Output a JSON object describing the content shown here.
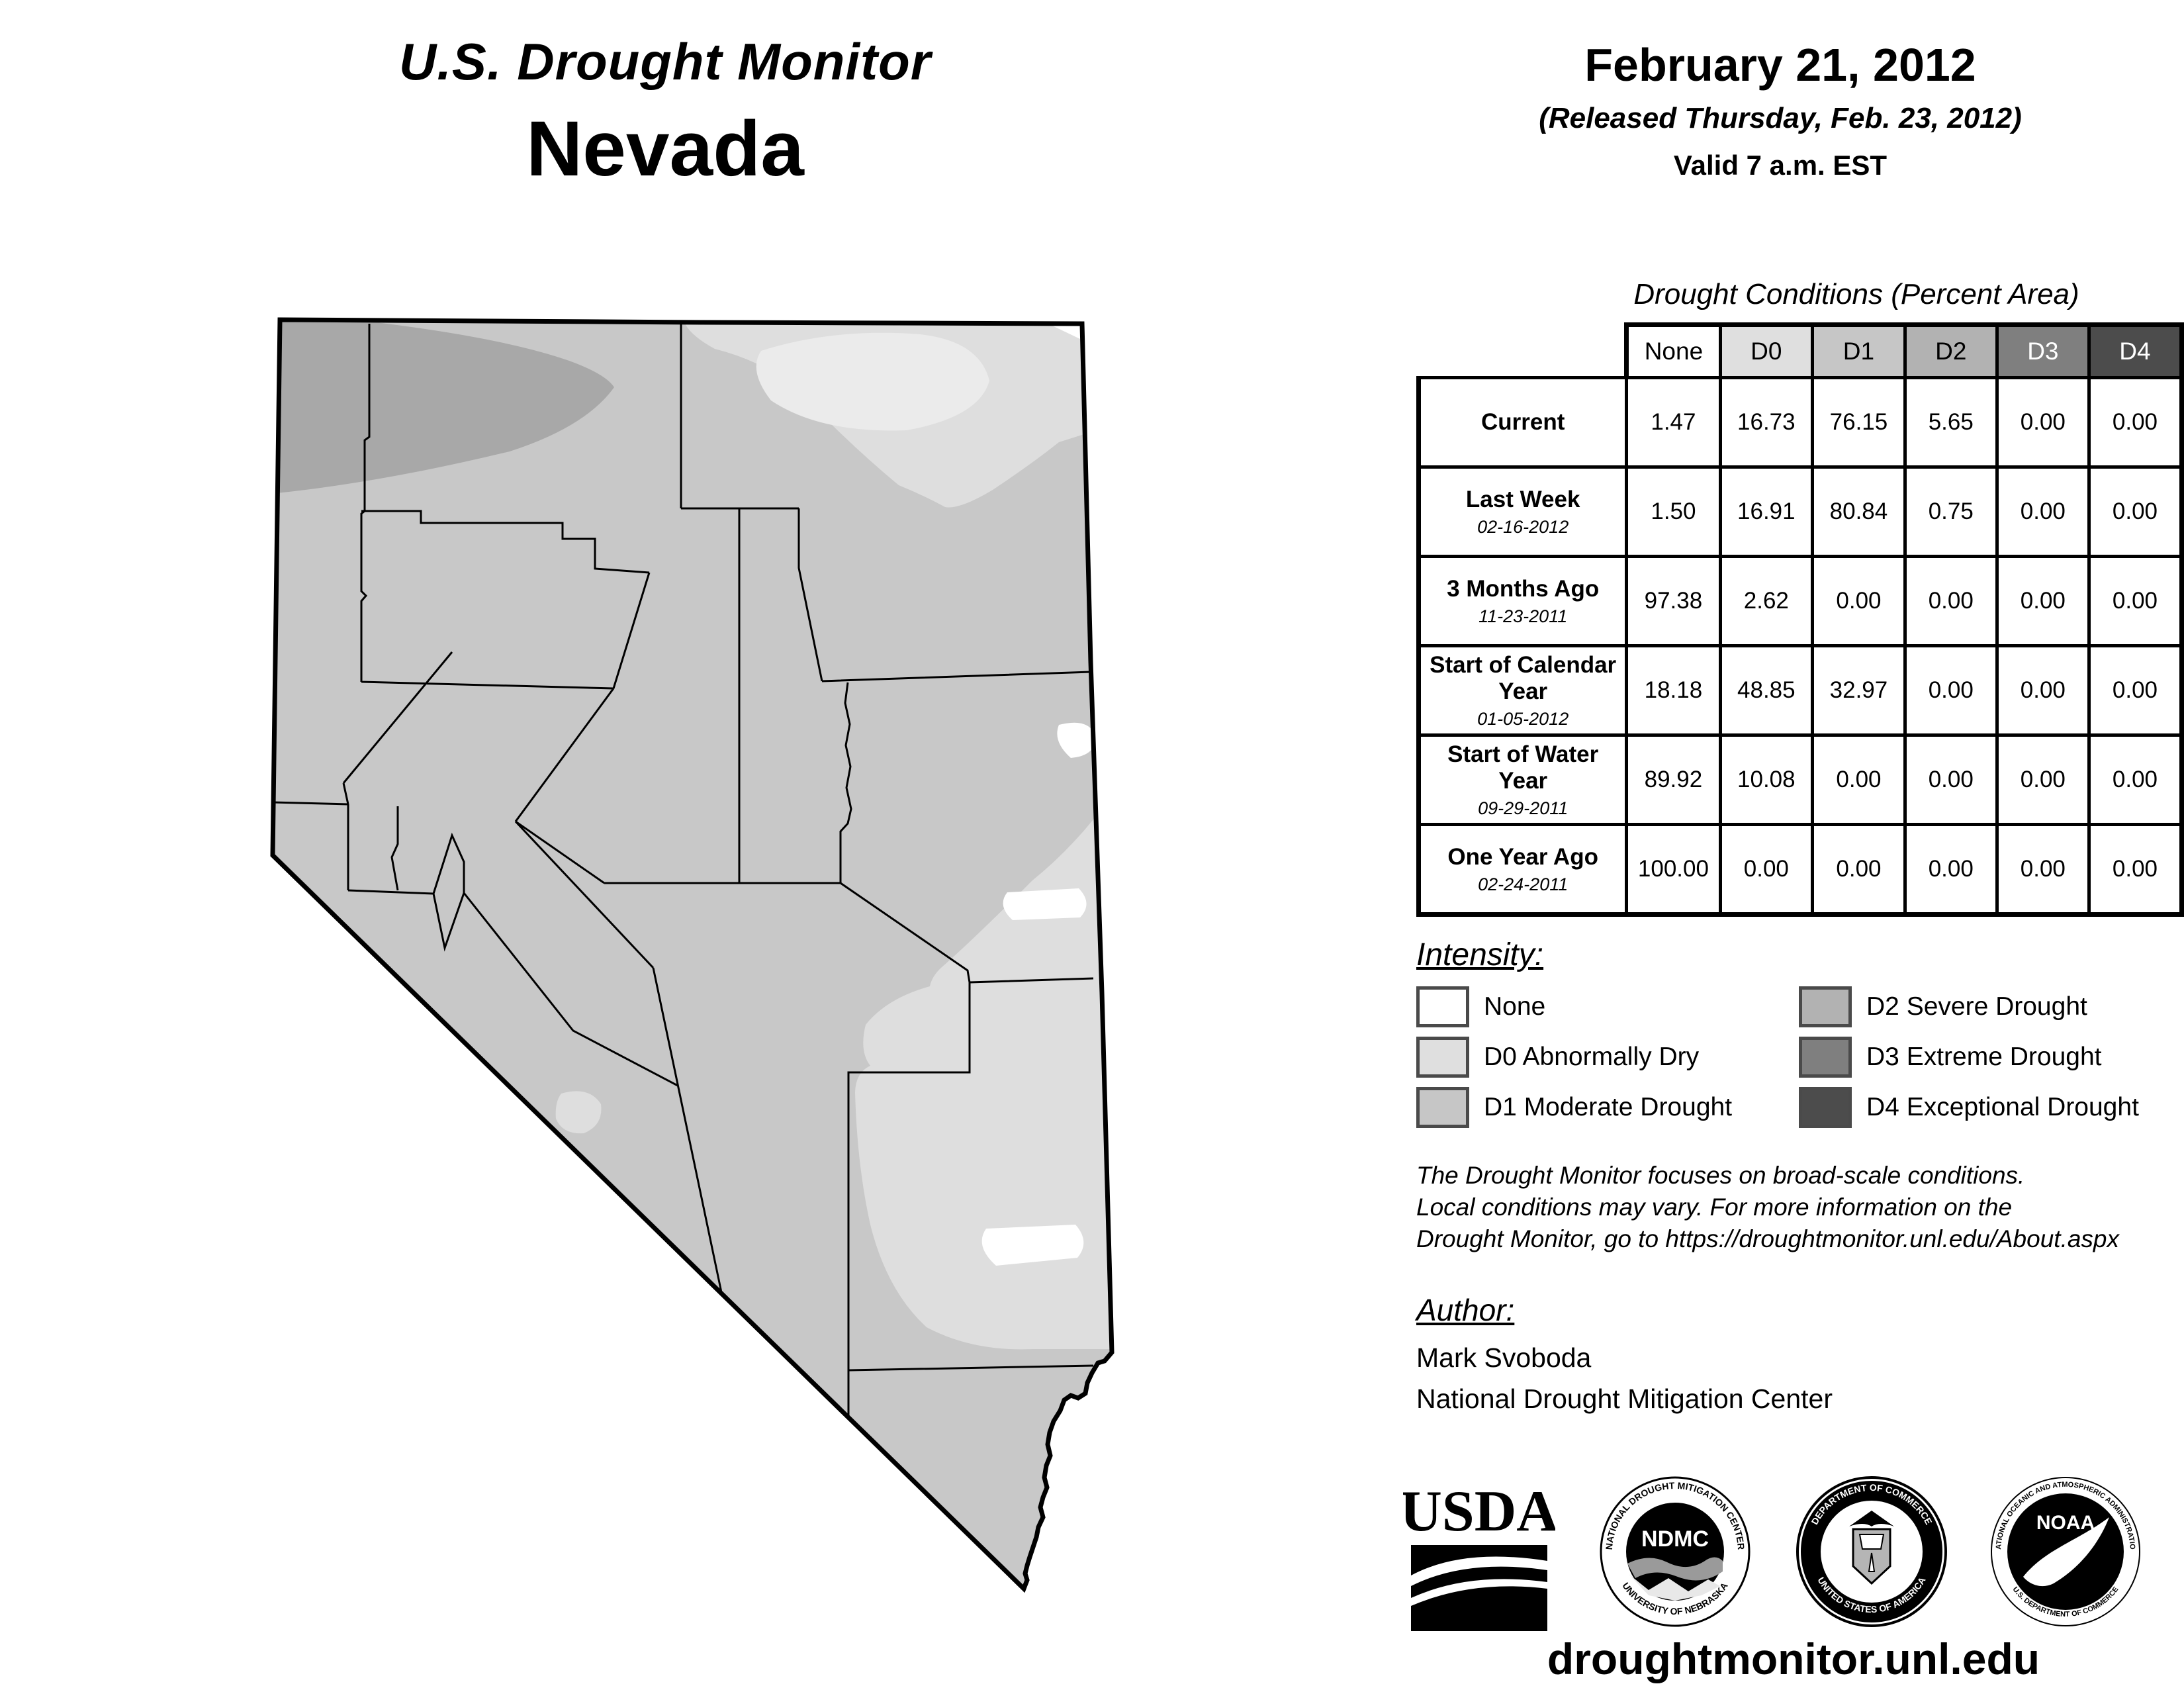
{
  "header": {
    "title": "U.S. Drought Monitor",
    "state": "Nevada"
  },
  "date_block": {
    "date": "February 21, 2012",
    "released": "(Released Thursday, Feb. 23, 2012)",
    "valid": "Valid 7 a.m. EST"
  },
  "table": {
    "title": "Drought Conditions (Percent Area)",
    "columns": [
      "None",
      "D0",
      "D1",
      "D2",
      "D3",
      "D4"
    ],
    "rows": [
      {
        "label": "Current",
        "date": "",
        "values": [
          "1.47",
          "16.73",
          "76.15",
          "5.65",
          "0.00",
          "0.00"
        ]
      },
      {
        "label": "Last Week",
        "date": "02-16-2012",
        "values": [
          "1.50",
          "16.91",
          "80.84",
          "0.75",
          "0.00",
          "0.00"
        ]
      },
      {
        "label": "3 Months Ago",
        "date": "11-23-2011",
        "values": [
          "97.38",
          "2.62",
          "0.00",
          "0.00",
          "0.00",
          "0.00"
        ]
      },
      {
        "label": "Start of Calendar Year",
        "date": "01-05-2012",
        "values": [
          "18.18",
          "48.85",
          "32.97",
          "0.00",
          "0.00",
          "0.00"
        ]
      },
      {
        "label": "Start of Water Year",
        "date": "09-29-2011",
        "values": [
          "89.92",
          "10.08",
          "0.00",
          "0.00",
          "0.00",
          "0.00"
        ]
      },
      {
        "label": "One Year Ago",
        "date": "02-24-2011",
        "values": [
          "100.00",
          "0.00",
          "0.00",
          "0.00",
          "0.00",
          "0.00"
        ]
      }
    ]
  },
  "legend": {
    "title": "Intensity:",
    "items": [
      {
        "label": "None",
        "color": "#ffffff"
      },
      {
        "label": "D0 Abnormally Dry",
        "color": "#dfdfdf"
      },
      {
        "label": "D1 Moderate Drought",
        "color": "#c6c6c6"
      },
      {
        "label": "D2 Severe Drought",
        "color": "#b2b2b2"
      },
      {
        "label": "D3 Extreme Drought",
        "color": "#7f7f7f"
      },
      {
        "label": "D4 Exceptional Drought",
        "color": "#4c4c4c"
      }
    ]
  },
  "colors": {
    "none": "#ffffff",
    "d0": "#dfdfdf",
    "d1": "#c6c6c6",
    "d2": "#b2b2b2",
    "d3": "#7f7f7f",
    "d4": "#4c4c4c",
    "header_light_text": "#ffffff",
    "map_d0": "#dedede",
    "map_d0_light": "#ebebeb",
    "map_d1": "#c8c8c8",
    "map_d2": "#a8a8a8",
    "map_none": "#ffffff",
    "line": "#000000"
  },
  "disclaimer": {
    "line1": "The Drought Monitor focuses on broad-scale conditions.",
    "line2": "Local conditions may vary. For more information on the",
    "line3": "Drought Monitor, go to https://droughtmonitor.unl.edu/About.aspx"
  },
  "author": {
    "heading": "Author:",
    "name": "Mark Svoboda",
    "org": "National Drought Mitigation Center"
  },
  "logos": {
    "usda": {
      "text": "USDA"
    },
    "ndmc": {
      "text": "NDMC",
      "ring_top": "NATIONAL DROUGHT MITIGATION CENTER",
      "ring_bottom": "UNIVERSITY OF NEBRASKA"
    },
    "doc": {
      "ring_top": "DEPARTMENT OF COMMERCE",
      "ring_bottom": "UNITED STATES OF AMERICA"
    },
    "noaa": {
      "text": "NOAA",
      "ring_top": "NATIONAL OCEANIC AND ATMOSPHERIC ADMINISTRATION",
      "ring_bottom": "U.S. DEPARTMENT OF COMMERCE"
    }
  },
  "footer": {
    "url": "droughtmonitor.unl.edu"
  }
}
